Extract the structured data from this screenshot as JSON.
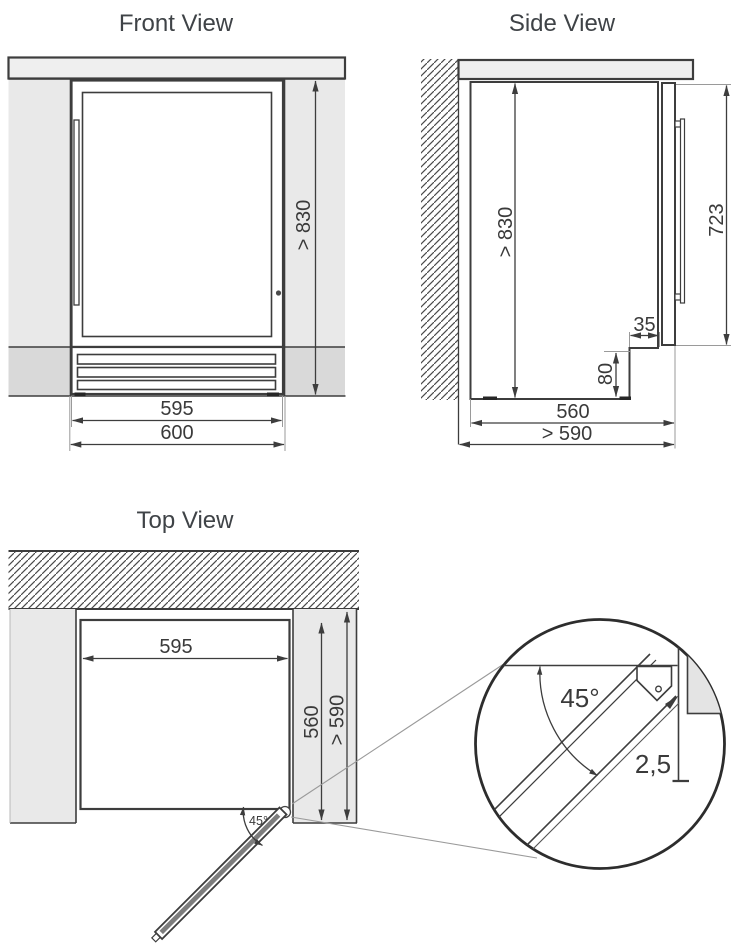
{
  "front": {
    "title": "Front View",
    "dim_niche_height": "> 830",
    "dim_appliance_width": "595",
    "dim_niche_width": "600"
  },
  "side": {
    "title": "Side View",
    "dim_niche_height": "> 830",
    "dim_door_height": "723",
    "dim_recess_depth": "35",
    "dim_recess_height": "80",
    "dim_body_depth": "560",
    "dim_niche_depth": "> 590"
  },
  "top": {
    "title": "Top View",
    "dim_appliance_width": "595",
    "dim_body_depth": "560",
    "dim_niche_depth": "> 590",
    "dim_door_angle": "45°"
  },
  "detail": {
    "dim_door_angle": "45°",
    "dim_clearance": "2,5"
  },
  "colors": {
    "panel": "#e9e9e9",
    "plinth": "#d9d9d9",
    "countertop": "#efefef",
    "line": "#3d3d3d",
    "text": "#3a3a3a",
    "door_core": "#7d7d7d"
  }
}
